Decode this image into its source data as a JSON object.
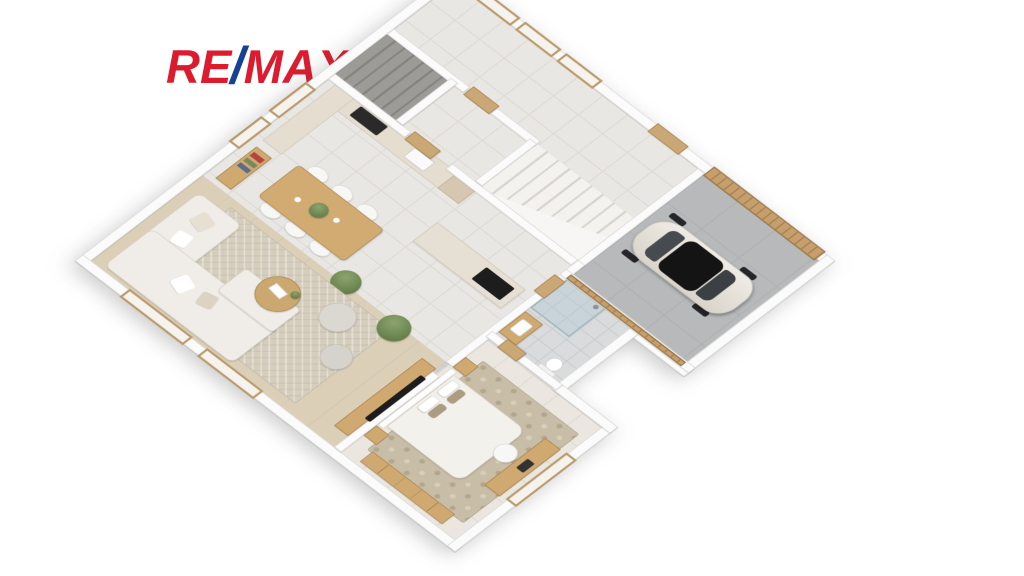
{
  "page": {
    "background": "#ffffff",
    "description": "3D isometric rendering of a house ground-floor plan on a white background, real-estate style"
  },
  "logo": {
    "re": "RE",
    "slash": "/",
    "max": "MAX",
    "color_red": "#DC1C2E",
    "color_blue": "#164194"
  },
  "palette": {
    "wall": "#fbfbfb",
    "wall_edge": "#d8d8d6",
    "tile_floor": "#e9e7e3",
    "bath_floor": "#d9dbdc",
    "garage_floor": "#b7b9ba",
    "living_wood_floor": "#dccfb8",
    "wood_trim": "#c9a876",
    "wood_dark": "#a8824f",
    "living_rug": "#d6cebd",
    "bedroom_rug": "#c8bda7",
    "upholstery": "#f0ede8",
    "car_body": "#e9e6df",
    "car_roof": "#141414",
    "greenery": "#7d9465"
  },
  "floorplan": {
    "view": "3d-isometric-floor-plan",
    "rooms": [
      {
        "id": "entry-hall",
        "floor": "tile"
      },
      {
        "id": "garage",
        "floor": "concrete"
      },
      {
        "id": "main-staircase",
        "floor": "white-steps"
      },
      {
        "id": "basement-staircase",
        "floor": "grey-steps"
      },
      {
        "id": "kitchen-dining",
        "floor": "tile"
      },
      {
        "id": "living-room",
        "floor": "wood"
      },
      {
        "id": "bathroom",
        "floor": "grey-tile"
      },
      {
        "id": "bedroom",
        "floor": "tile"
      }
    ],
    "furniture": {
      "garage": [
        "classic-car"
      ],
      "kitchen_dining": [
        "l-shaped-counter",
        "cooktop",
        "sink",
        "kitchen-island",
        "island-cooktop",
        "dining-table",
        "six-chairs",
        "sideboard-with-books",
        "potted-plant"
      ],
      "living_room": [
        "corner-sofa",
        "throw-pillows",
        "round-coffee-table",
        "two-round-poufs",
        "tv-console",
        "wall-tv",
        "herringbone-rug",
        "potted-plant"
      ],
      "bedroom": [
        "double-bed",
        "headboard",
        "pillows",
        "two-nightstands",
        "desk",
        "desk-chair",
        "wardrobe",
        "patterned-rug"
      ],
      "bathroom": [
        "glass-shower",
        "wood-vanity-sink",
        "toilet"
      ],
      "openings": [
        "garage-slat-door",
        "front-door",
        "interior-doors",
        "wood-framed-windows"
      ]
    }
  }
}
